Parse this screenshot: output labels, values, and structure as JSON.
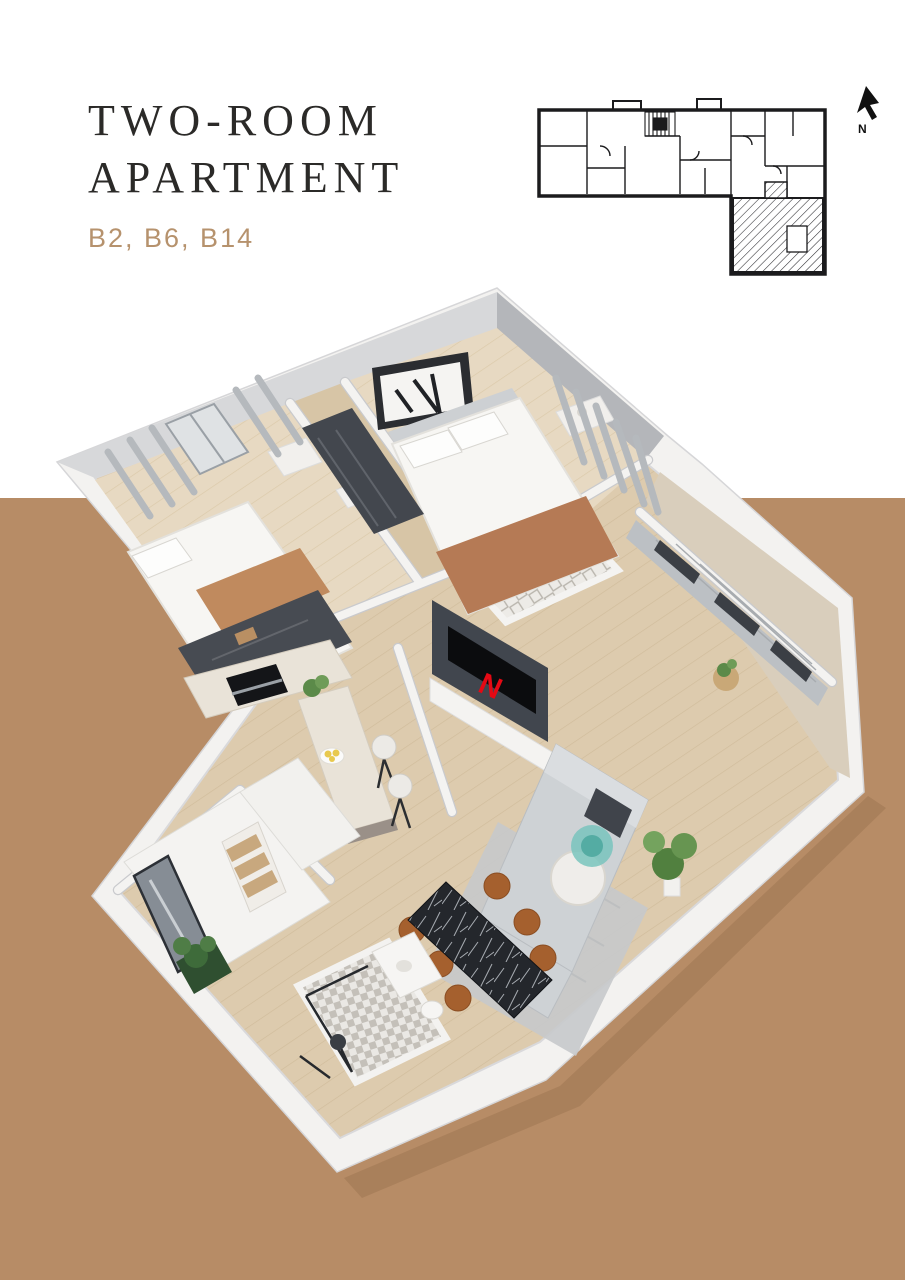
{
  "header": {
    "title_line1": "TWO-ROOM",
    "title_line2": "APARTMENT",
    "units": "B2, B6, B14"
  },
  "site_plan": {
    "north_label": "N",
    "highlighted_unit": "hatched lower-right section"
  },
  "render": {
    "tv_logo": "N"
  },
  "colors": {
    "page_white": "#ffffff",
    "background_tan": "#b78c66",
    "title_dark": "#2b2a28",
    "units_tan": "#b6926d",
    "plan_line": "#1b1b1d",
    "netflix_red": "#e50914",
    "wall_white": "#f3f2f0",
    "floor_wood": "#ddcbae",
    "floor_wood_light": "#e7d9c2",
    "tile_light": "#eceae6",
    "rug_gray": "#c7c9cb",
    "sofa_gray": "#ced2d5",
    "wardrobe_dark": "#474b52",
    "chair_rust": "#a5602e",
    "table_black_marble": "#24272c",
    "plant_green": "#51803f",
    "curtain_gray": "#b9bdc1",
    "throw_rust": "#b57a55"
  }
}
